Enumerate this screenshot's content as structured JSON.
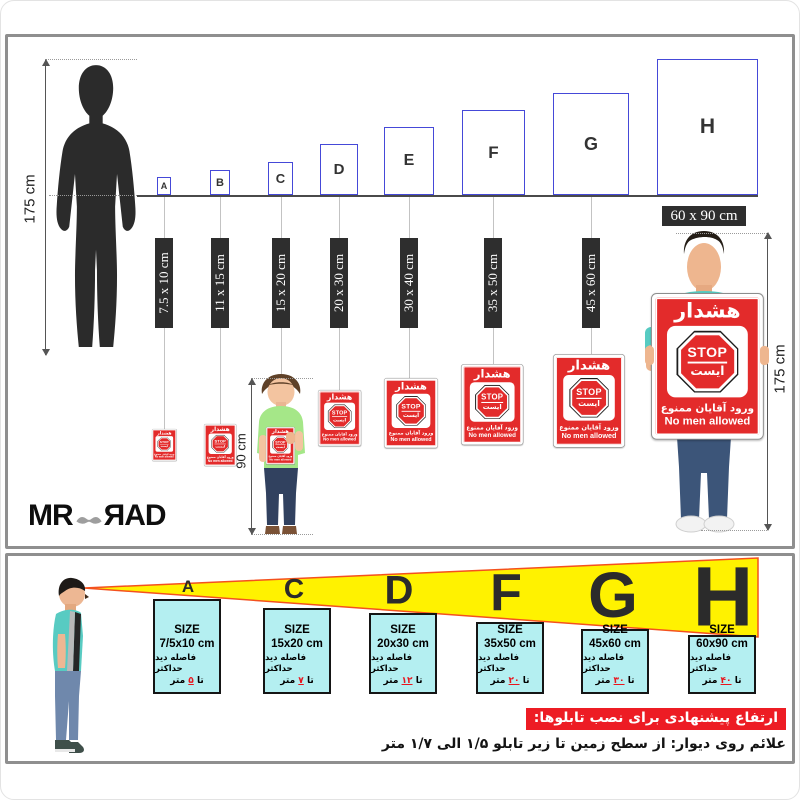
{
  "brand": {
    "mr": "MR",
    "rad": "ЯAD"
  },
  "top": {
    "silhouette_height": "175 cm",
    "child_height": "90 cm",
    "holder_height": "175 cm",
    "boxes": [
      {
        "letter": "A",
        "size": "7.5 x 10 cm"
      },
      {
        "letter": "B",
        "size": "11 x 15 cm"
      },
      {
        "letter": "C",
        "size": "15 x 20 cm"
      },
      {
        "letter": "D",
        "size": "20 x 30 cm"
      },
      {
        "letter": "E",
        "size": "30 x 40 cm"
      },
      {
        "letter": "F",
        "size": "35 x 50 cm"
      },
      {
        "letter": "G",
        "size": "45 x 60 cm"
      },
      {
        "letter": "H",
        "size": "60 x 90 cm"
      }
    ]
  },
  "sign": {
    "warning": "هشدار",
    "stop_en": "STOP",
    "stop_fa": "ایست",
    "line_fa": "ورود آقایان ممنوع",
    "line_en": "No men allowed"
  },
  "bottom": {
    "items": [
      {
        "letter": "A",
        "size_title": "SIZE",
        "size": "7/5x10 cm",
        "dist_label": "فاصله دید حداکثر",
        "to": "تا",
        "num": "۵",
        "unit": "متر"
      },
      {
        "letter": "C",
        "size_title": "SIZE",
        "size": "15x20 cm",
        "dist_label": "فاصله دید حداکثر",
        "to": "تا",
        "num": "۷",
        "unit": "متر"
      },
      {
        "letter": "D",
        "size_title": "SIZE",
        "size": "20x30 cm",
        "dist_label": "فاصله دید حداکثر",
        "to": "تا",
        "num": "۱۲",
        "unit": "متر"
      },
      {
        "letter": "F",
        "size_title": "SIZE",
        "size": "35x50 cm",
        "dist_label": "فاصله دید حداکثر",
        "to": "تا",
        "num": "۲۰",
        "unit": "متر"
      },
      {
        "letter": "G",
        "size_title": "SIZE",
        "size": "45x60 cm",
        "dist_label": "فاصله دید حداکثر",
        "to": "تا",
        "num": "۳۰",
        "unit": "متر"
      },
      {
        "letter": "H",
        "size_title": "SIZE",
        "size": "60x90 cm",
        "dist_label": "فاصله دید حداکثر",
        "to": "تا",
        "num": "۴۰",
        "unit": "متر"
      }
    ],
    "heading": "ارتفاع پیشنهادی برای نصب تابلوها:",
    "note": "علائم روی دیوار: از سطح زمین تا زیر تابلو ۱/۵ الی ۱/۷ متر"
  },
  "colors": {
    "sign_red": "#e32b2b",
    "banner_red": "#ed1c24",
    "box_blue": "#4549d8",
    "cyan": "#b4eff1",
    "yellow": "#fff200",
    "triangle_edge": "#f4511e",
    "label_dark": "#2e2e2e",
    "shirt_teal": "#57cbc2",
    "child_green": "#a5e788"
  }
}
